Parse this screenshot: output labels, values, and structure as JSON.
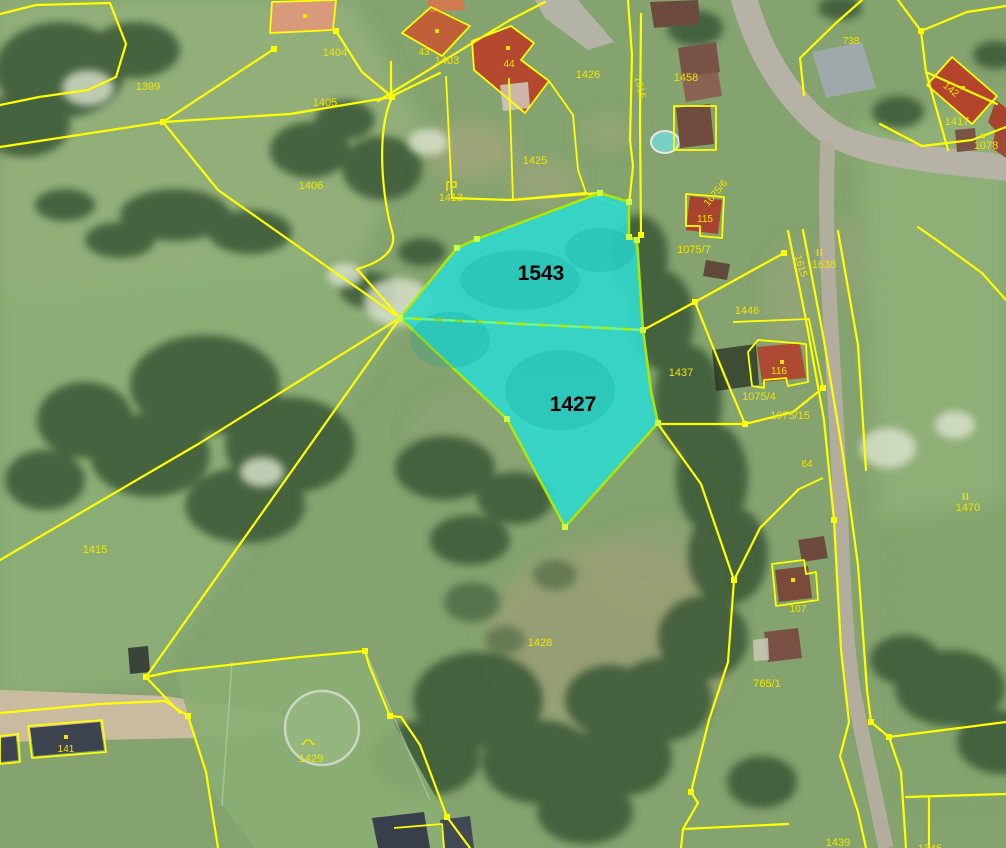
{
  "map": {
    "type": "cadastral-orthophoto",
    "colors": {
      "boundary_line": "#ffff00",
      "parcel_label": "#f0e500",
      "highlight_fill": "#31d7cb",
      "highlight_border": "#aee800",
      "highlight_divider": "#63f79e",
      "highlight_number": "#000000"
    },
    "highlight": {
      "parcels": [
        {
          "id": "1543"
        },
        {
          "id": "1427"
        }
      ]
    },
    "parcel_labels": [
      {
        "text": "1399"
      },
      {
        "text": "1404"
      },
      {
        "text": "43"
      },
      {
        "text": "1403"
      },
      {
        "text": "44"
      },
      {
        "text": "1426"
      },
      {
        "text": "1405"
      },
      {
        "text": "1425"
      },
      {
        "text": "1413"
      },
      {
        "text": "1406"
      },
      {
        "text": "1458"
      },
      {
        "text": "1615"
      },
      {
        "text": "738"
      },
      {
        "text": "142"
      },
      {
        "text": "1417"
      },
      {
        "text": "1078"
      },
      {
        "text": "1075/6"
      },
      {
        "text": "115"
      },
      {
        "text": "1075/7"
      },
      {
        "text": "1638"
      },
      {
        "text": "1615"
      },
      {
        "text": "1446"
      },
      {
        "text": "1437"
      },
      {
        "text": "116"
      },
      {
        "text": "1075/4"
      },
      {
        "text": "1075/15"
      },
      {
        "text": "64"
      },
      {
        "text": "1470"
      },
      {
        "text": "1415"
      },
      {
        "text": "1428"
      },
      {
        "text": "107"
      },
      {
        "text": "765/1"
      },
      {
        "text": "1429"
      },
      {
        "text": "141"
      },
      {
        "text": "1439"
      },
      {
        "text": "1345"
      }
    ],
    "road_class_symbols": [
      {
        "text": "II"
      },
      {
        "text": "II"
      }
    ]
  }
}
